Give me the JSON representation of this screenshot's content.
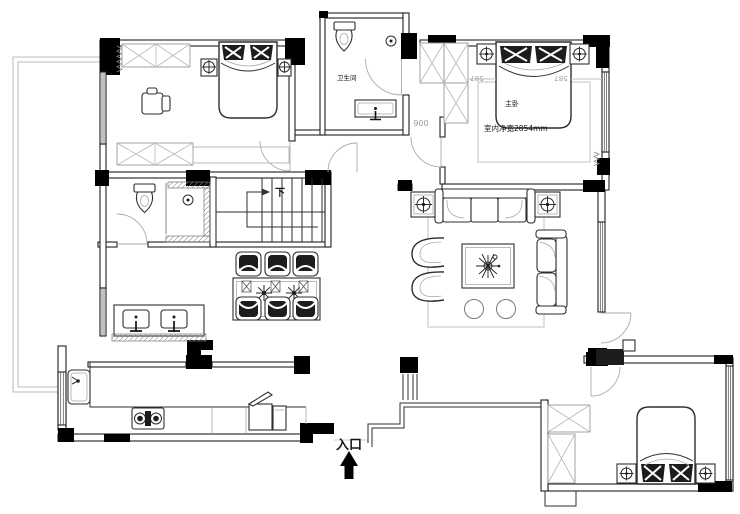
{
  "page": {
    "background": "#ffffff",
    "width": 740,
    "height": 514
  },
  "colors": {
    "wall_line": "#1f1f1f",
    "column_fill": "#000000",
    "furniture_line": "#2e2e2e",
    "light_line": "#9c9c9c",
    "dark_fill": "#1c1c1c"
  },
  "labels": {
    "bathroom": "卫生间",
    "master_bedroom": "主卧",
    "master_width": "室内净宽2854mm",
    "room_code": "006",
    "dim_left": "587",
    "dim_right": "587",
    "stairs_down": "下",
    "entrance": "入口"
  },
  "icons": {
    "entrance_arrow": "filled-up-arrow",
    "stair_direction_arrow": "right-arrow",
    "bedside_lamp": "circle-with-cross",
    "shower_head": "circle-with-dot",
    "wardrobe": "rectangle-with-x",
    "plant": "starburst-lines"
  }
}
